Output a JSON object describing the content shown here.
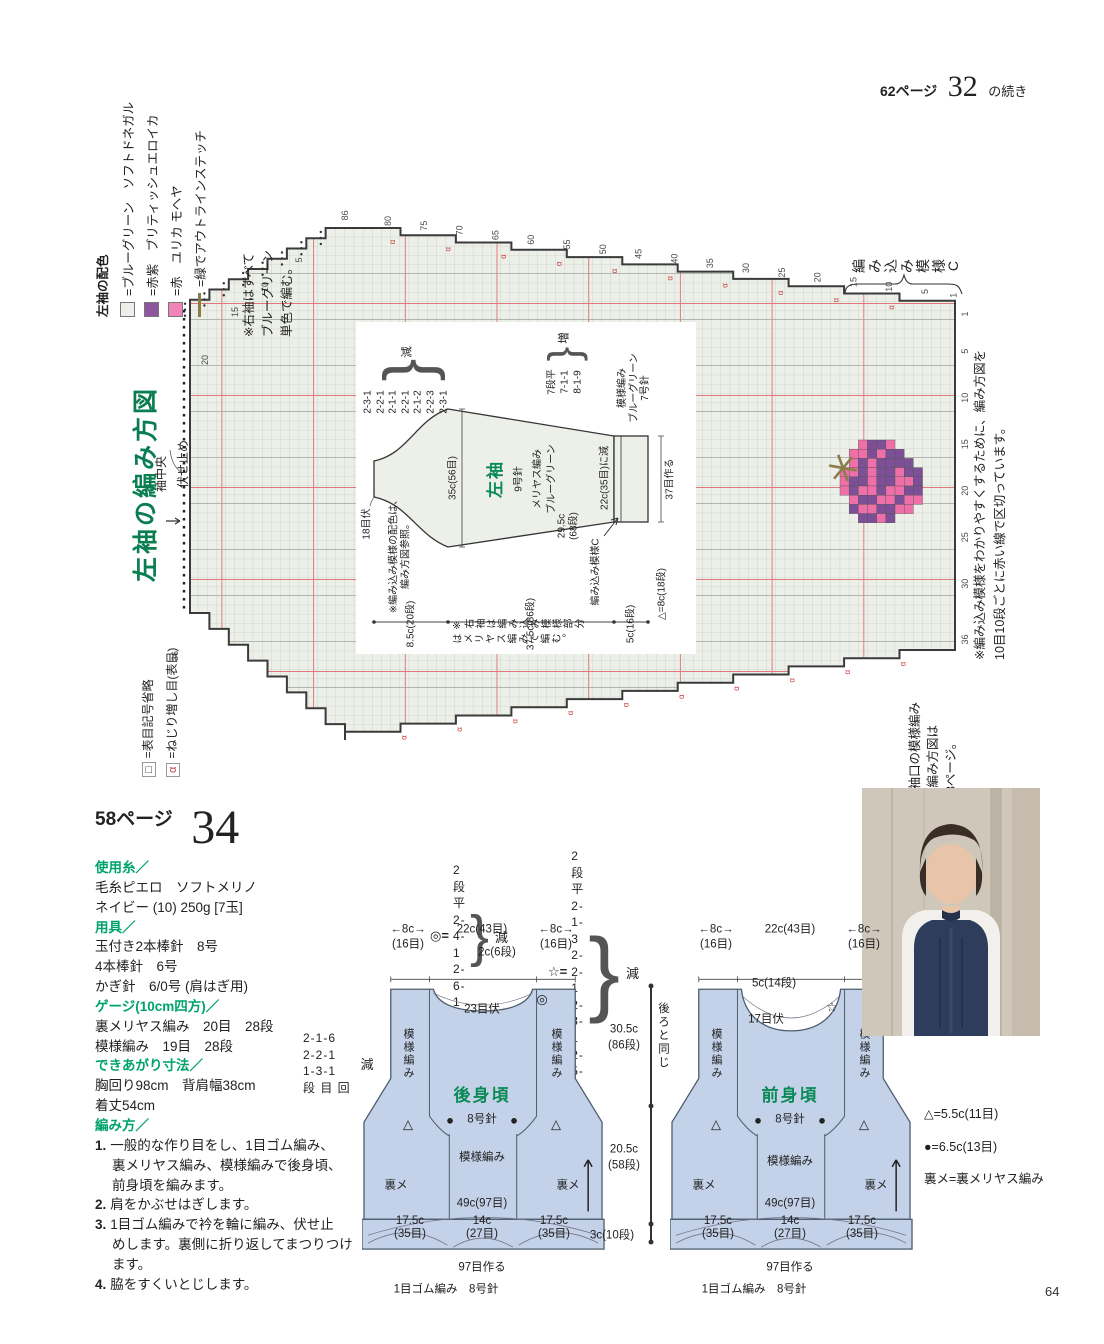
{
  "page": {
    "continuation_ref": "62ページ",
    "continuation_num": "32",
    "continuation_suffix": "の続き",
    "page_number": "64"
  },
  "sleeve_chart": {
    "title": "左袖の編み方図",
    "colors_legend": {
      "title": "左袖の配色",
      "items": [
        {
          "label": "=ブルーグリーン　ソフトドネガル",
          "swatch": "#edf0ea",
          "type": "box"
        },
        {
          "label": "=赤紫　ブリティッシュエロイカ",
          "swatch": "#8f56a0",
          "type": "box"
        },
        {
          "label": "=赤　ユリカ モヘヤ",
          "swatch": "#f285b8",
          "type": "box"
        },
        {
          "label": "=緑でアウトラインステッチ",
          "swatch": "#8a7d4a",
          "type": "line"
        }
      ]
    },
    "note_right_sleeve": "※右袖はすべて\nブルーグリーン\n単色で編む。",
    "stitch_legend": [
      {
        "symbol": "□",
        "label": "=表目記号省略",
        "color": "#333"
      },
      {
        "symbol": "α",
        "label": "=ねじり増し目(表目)",
        "color": "#cc3a3a"
      }
    ],
    "labels": {
      "bind_off": "伏せ止め",
      "sleeve_center": "袖中央",
      "pattern_c": "編み込み模様C"
    },
    "note_red_lines": "※編み込み模様をわかりやすくするために、編み方図を\n10目10段ごとに赤い線で区切っています。",
    "note_cuff": "※袖口の模様編み\nの編み方図は\n63ページ。",
    "grid": {
      "top_numbers": [
        86,
        80,
        75,
        70,
        65,
        60,
        55,
        50,
        45,
        40,
        35,
        30,
        25,
        20,
        15,
        10,
        5,
        1
      ],
      "right_numbers": [
        1,
        5,
        10,
        15,
        20,
        25,
        30,
        36
      ],
      "left_numbers": [
        [
          5,
          152,
          72
        ],
        [
          10,
          118,
          99
        ],
        [
          15,
          88,
          124
        ],
        [
          20,
          58,
          172
        ],
        [
          36,
          28,
          468
        ]
      ]
    },
    "motif": {
      "rows": [
        "..PDDP...",
        ".PPDPDD..",
        ".PDPDDDD.",
        "PPDPDDPDD",
        "PDDPDDPPD",
        "PDPPDPPDD",
        ".PDDPPDPP",
        ".DPPDDPP.",
        "..DDPD..."
      ],
      "colors": {
        "P": "#ef6fa9",
        "D": "#7c4f96"
      },
      "stem_color": "#8a7d4a"
    },
    "schematic": {
      "name": "左袖",
      "needle": "9号針",
      "stitch": "メリヤス編み",
      "yarn": "ブルーグリーン",
      "bind": "18目伏",
      "width_top": "35c(56目)",
      "upper_h": "29.5c\n(68段)",
      "dec_list": [
        "2-3-1",
        "2-2-1",
        "2-1-1",
        "2-2-1",
        "2-1-2",
        "2-2-3",
        "2-3-1"
      ],
      "dec_tail": "減",
      "inc_list": [
        "7段平",
        "7-1-1",
        "8-1-9"
      ],
      "inc_tail": "増",
      "pattern_c": "編み込み模様C",
      "cuff_dec": "22c(35目)に減",
      "band": "模様編み\nブルーグリーン\n7号針",
      "cast_on": "37目作る",
      "tri": "△=8c(18段)",
      "dims": [
        "8.5c(20段)",
        "37.5c(86段)",
        "5c(16段)"
      ],
      "note_colors": "※編み込み模様の配色は、\n編み方図参照。",
      "note_right": "※右袖は編み込み模様部分はメリヤス編みで編む。"
    }
  },
  "pattern34": {
    "page_ref": "58ページ",
    "number": "34",
    "info_lines": [
      {
        "k": "h",
        "t": "使用糸／"
      },
      {
        "k": "t",
        "t": "毛糸ピエロ　ソフトメリノ"
      },
      {
        "k": "t",
        "t": "ネイビー (10) 250g [7玉]"
      },
      {
        "k": "h",
        "t": "用具／"
      },
      {
        "k": "t",
        "t": "玉付き2本棒針　8号"
      },
      {
        "k": "t",
        "t": "4本棒針　6号"
      },
      {
        "k": "t",
        "t": "かぎ針　6/0号 (肩はぎ用)"
      },
      {
        "k": "h",
        "t": "ゲージ(10cm四方)／"
      },
      {
        "k": "t",
        "t": "裏メリヤス編み　20目　28段"
      },
      {
        "k": "t",
        "t": "模様編み　19目　28段"
      },
      {
        "k": "h",
        "t": "できあがり寸法／"
      },
      {
        "k": "t",
        "t": "胸回り98cm　背肩幅38cm"
      },
      {
        "k": "t",
        "t": "着丈54cm"
      },
      {
        "k": "h",
        "t": "編み方／"
      },
      {
        "k": "s",
        "n": "1.",
        "t": "一般的な作り目をし、1目ゴム編み、"
      },
      {
        "k": "c",
        "t": "裏メリヤス編み、模様編みで後身頃、"
      },
      {
        "k": "c",
        "t": "前身頃を編みます。"
      },
      {
        "k": "s",
        "n": "2.",
        "t": "肩をかぶせはぎします。"
      },
      {
        "k": "s",
        "n": "3.",
        "t": "1目ゴム編みで衿を輪に編み、伏せ止"
      },
      {
        "k": "c",
        "t": "めします。裏側に折り返してまつりつけ"
      },
      {
        "k": "c",
        "t": "ます。"
      },
      {
        "k": "s",
        "n": "4.",
        "t": "脇をすくいとじします。"
      }
    ],
    "dec_formulas": [
      {
        "sym": "◎=",
        "lines": [
          "2段平",
          "2-4-1",
          "2-6-1"
        ],
        "tail": "減",
        "x": 430,
        "y": 862
      },
      {
        "sym": "☆=",
        "lines": [
          "2段平",
          "2-1-3",
          "2-2-1",
          "2-3-1",
          "2-5-1"
        ],
        "tail": "減",
        "x": 548,
        "y": 848
      }
    ],
    "armhole_dec": {
      "lines": [
        "2-1-6",
        "2-2-1",
        "1-3-1",
        "段 目 回"
      ],
      "tail": "減"
    },
    "back": {
      "top_dims": [
        {
          "t": "←8c→",
          "x": 408,
          "y": 930
        },
        {
          "t": "(16目)",
          "x": 408,
          "y": 945
        },
        {
          "t": "22c(43目)",
          "x": 482,
          "y": 930
        },
        {
          "t": "2c(6段)",
          "x": 497,
          "y": 953
        },
        {
          "t": "←8c→",
          "x": 556,
          "y": 930
        },
        {
          "t": "(16目)",
          "x": 556,
          "y": 945
        }
      ],
      "labels": [
        {
          "t": "23目伏",
          "x": 120,
          "y": 40
        },
        {
          "t": "◎",
          "x": 180,
          "y": 30,
          "c": "sym"
        },
        {
          "t": "模様編み",
          "x": 46,
          "y": 100,
          "c": "vt"
        },
        {
          "t": "模様編み",
          "x": 194,
          "y": 100,
          "c": "vt"
        },
        {
          "t": "後身頃",
          "x": 120,
          "y": 126,
          "c": "pname"
        },
        {
          "t": "8号針",
          "x": 120,
          "y": 150
        },
        {
          "t": "模様編み",
          "x": 120,
          "y": 188
        },
        {
          "t": "△",
          "x": 46,
          "y": 155,
          "c": "sym"
        },
        {
          "t": "△",
          "x": 194,
          "y": 155,
          "c": "sym"
        },
        {
          "t": "●",
          "x": 88,
          "y": 151,
          "c": "sym"
        },
        {
          "t": "●",
          "x": 152,
          "y": 151,
          "c": "sym"
        },
        {
          "t": "裏メ",
          "x": 34,
          "y": 216
        },
        {
          "t": "裏メ",
          "x": 206,
          "y": 216
        },
        {
          "t": "49c(97目)",
          "x": 120,
          "y": 234
        },
        {
          "t": "17.5c\n(35目)",
          "x": 48,
          "y": 258,
          "c": "two"
        },
        {
          "t": "14c\n(27目)",
          "x": 120,
          "y": 258,
          "c": "two"
        },
        {
          "t": "17.5c\n(35目)",
          "x": 192,
          "y": 258,
          "c": "two"
        },
        {
          "t": "97目作る",
          "x": 120,
          "y": 298
        },
        {
          "t": "1目ゴム編み　8号針",
          "x": 84,
          "y": 320
        }
      ]
    },
    "front": {
      "top_dims": [
        {
          "t": "←8c→",
          "x": 716,
          "y": 930
        },
        {
          "t": "(16目)",
          "x": 716,
          "y": 945
        },
        {
          "t": "22c(43目)",
          "x": 790,
          "y": 930
        },
        {
          "t": "←8c→",
          "x": 864,
          "y": 930
        },
        {
          "t": "(16目)",
          "x": 864,
          "y": 945
        }
      ],
      "labels": [
        {
          "t": "5c(14段)",
          "x": 104,
          "y": 14
        },
        {
          "t": "17目伏",
          "x": 96,
          "y": 50
        },
        {
          "t": "☆",
          "x": 162,
          "y": 38,
          "c": "sym"
        },
        {
          "t": "模様編み",
          "x": 46,
          "y": 100,
          "c": "vt"
        },
        {
          "t": "模様編み",
          "x": 194,
          "y": 100,
          "c": "vt"
        },
        {
          "t": "前身頃",
          "x": 120,
          "y": 126,
          "c": "pname"
        },
        {
          "t": "8号針",
          "x": 120,
          "y": 150
        },
        {
          "t": "模様編み",
          "x": 120,
          "y": 192
        },
        {
          "t": "△",
          "x": 46,
          "y": 155,
          "c": "sym"
        },
        {
          "t": "△",
          "x": 194,
          "y": 155,
          "c": "sym"
        },
        {
          "t": "●",
          "x": 88,
          "y": 151,
          "c": "sym"
        },
        {
          "t": "●",
          "x": 152,
          "y": 151,
          "c": "sym"
        },
        {
          "t": "裏メ",
          "x": 34,
          "y": 216
        },
        {
          "t": "裏メ",
          "x": 206,
          "y": 216
        },
        {
          "t": "49c(97目)",
          "x": 120,
          "y": 234
        },
        {
          "t": "17.5c\n(35目)",
          "x": 48,
          "y": 258,
          "c": "two"
        },
        {
          "t": "14c\n(27目)",
          "x": 120,
          "y": 258,
          "c": "two"
        },
        {
          "t": "17.5c\n(35目)",
          "x": 192,
          "y": 258,
          "c": "two"
        },
        {
          "t": "97目作る",
          "x": 120,
          "y": 298
        },
        {
          "t": "1目ゴム編み　8号針",
          "x": 84,
          "y": 320
        }
      ]
    },
    "same_as_back": "後ろと同じ",
    "side_dims": [
      {
        "t": "30.5c",
        "x": 624,
        "y": 1030
      },
      {
        "t": "(86段)",
        "x": 624,
        "y": 1046
      },
      {
        "t": "20.5c",
        "x": 624,
        "y": 1150
      },
      {
        "t": "(58段)",
        "x": 624,
        "y": 1166
      },
      {
        "t": "3c(10段)",
        "x": 612,
        "y": 1236
      }
    ],
    "legend": [
      "△=5.5c(11目)",
      "●=6.5c(13目)",
      "裏メ=裏メリヤス編み"
    ]
  }
}
